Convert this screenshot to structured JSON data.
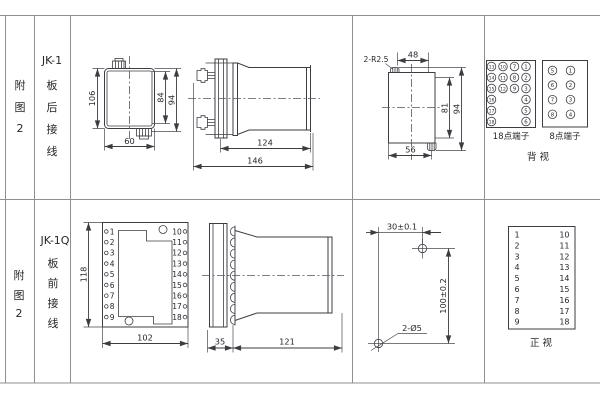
{
  "page": {
    "background": "#ffffff",
    "line_color": "#3c3c44",
    "grid_color": "#8f8f8f"
  },
  "rows": [
    {
      "fig": [
        "附",
        "图",
        "2"
      ],
      "model": "JK-1",
      "wiring": [
        "板",
        "后",
        "接",
        "线"
      ]
    },
    {
      "fig": [
        "附",
        "图",
        "2"
      ],
      "model": "JK-1Q",
      "wiring": [
        "板",
        "前",
        "接",
        "线"
      ]
    }
  ],
  "jk1": {
    "front": {
      "dim_left": "106",
      "dim_inner_right": "84",
      "dim_outer_right": "94",
      "dim_bottom": "60"
    },
    "side": {
      "dim_body": "124",
      "dim_total": "146"
    },
    "rear": {
      "corner_label": "2-R2.5",
      "dim_top": "48",
      "dim_inner_right": "81",
      "dim_outer_right": "94",
      "dim_bottom": "56"
    }
  },
  "jk1q": {
    "front": {
      "dim_left": "118",
      "dim_bottom": "102",
      "left_terminals": [
        "1",
        "2",
        "3",
        "4",
        "5",
        "6",
        "7",
        "8",
        "9"
      ],
      "right_terminals": [
        "10",
        "11",
        "12",
        "13",
        "14",
        "15",
        "16",
        "17",
        "18"
      ]
    },
    "side": {
      "dim_flange": "35",
      "dim_body": "121"
    },
    "drill": {
      "dim_horizontal": "30±0.1",
      "dim_vertical": "100±0.2",
      "hole_label": "2-Ø5"
    }
  },
  "terminals": {
    "back_view": {
      "t18": {
        "label": "18点端子",
        "cols": [
          [
            "13",
            "14",
            "15",
            "16",
            "17",
            "18"
          ],
          [
            "10",
            "11",
            "12"
          ],
          [
            "7",
            "8",
            "9"
          ],
          [
            "1",
            "2",
            "3",
            "4",
            "5",
            "6"
          ]
        ]
      },
      "t8": {
        "label": "8点端子",
        "cols": [
          [
            "5",
            "6",
            "7",
            "8"
          ],
          [
            "1",
            "2",
            "3",
            "4"
          ]
        ]
      },
      "view_label": "背  视"
    },
    "front_view": {
      "left": [
        "1",
        "2",
        "3",
        "4",
        "5",
        "6",
        "7",
        "8",
        "9"
      ],
      "right": [
        "10",
        "11",
        "12",
        "13",
        "14",
        "15",
        "16",
        "17",
        "18"
      ],
      "view_label": "正  视"
    }
  }
}
